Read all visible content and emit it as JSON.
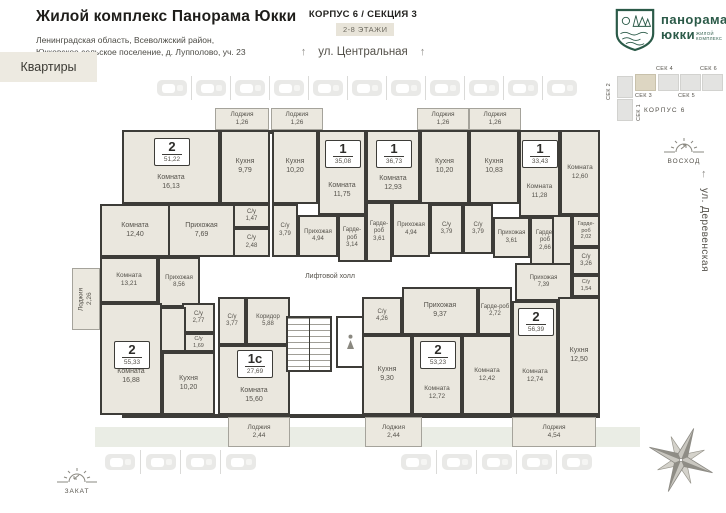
{
  "header": {
    "title": "Жилой комплекс Панорама Юкки",
    "address1": "Ленинградская область, Всеволжский район,",
    "address2": "Юкковское сельское поселение, д. Лупполово, уч. 23",
    "apartments_button": "Квартиры",
    "korpus": "КОРПУС 6 / СЕКЦИЯ 3",
    "floors_badge": "2-8 ЭТАЖИ",
    "street_top": "ул. Центральная",
    "street_right": "ул. Деревенская"
  },
  "logo": {
    "line1": "панорама",
    "line2": "юкки",
    "sub1": "жилой",
    "sub2": "комплекс"
  },
  "minimap": {
    "sec1": "СЕК 1",
    "sec2": "СЕК 2",
    "sec3": "СЕК 3",
    "sec4": "СЕК 4",
    "sec5": "СЕК 5",
    "sec6": "СЕК 6",
    "korpus": "КОРПУС 6",
    "active_section": "СЕК 3"
  },
  "legend": {
    "sunrise": "ВОСХОД",
    "sunset": "ЗАКАТ"
  },
  "colors": {
    "wall": "#3d3c38",
    "room_fill": "#eae7de",
    "accent_beige": "#edeae1",
    "logo_green": "#2b5a48"
  },
  "plan": {
    "lift_hall_label": "Лифтовой холл",
    "apartments": [
      {
        "type": "2",
        "area": "51,22",
        "bx": 171,
        "by": 138
      },
      {
        "type": "1",
        "area": "35,08",
        "bx": 342,
        "by": 140
      },
      {
        "type": "1",
        "area": "36,73",
        "bx": 393,
        "by": 140
      },
      {
        "type": "1",
        "area": "33,43",
        "bx": 539,
        "by": 140
      },
      {
        "type": "2",
        "area": "56,39",
        "bx": 535,
        "by": 308
      },
      {
        "type": "2",
        "area": "53,23",
        "bx": 437,
        "by": 341
      },
      {
        "type": "2",
        "area": "55,33",
        "bx": 131,
        "by": 341
      },
      {
        "type": "1с",
        "area": "27,69",
        "bx": 254,
        "by": 350
      }
    ],
    "rooms": [
      {
        "name": "Комната",
        "area": "16,13",
        "x": 122,
        "y": 130,
        "w": 98,
        "h": 74,
        "pt": 32
      },
      {
        "name": "Кухня",
        "area": "9,79",
        "x": 220,
        "y": 130,
        "w": 50,
        "h": 74
      },
      {
        "name": "С/у",
        "area": "1,47",
        "x": 233,
        "y": 204,
        "w": 37,
        "h": 24,
        "fs": 6
      },
      {
        "name": "С/у",
        "area": "2,48",
        "x": 233,
        "y": 228,
        "w": 37,
        "h": 29,
        "fs": 6
      },
      {
        "name": "Прихожая",
        "area": "7,69",
        "x": 168,
        "y": 204,
        "w": 67,
        "h": 53
      },
      {
        "name": "Комната",
        "area": "12,40",
        "x": 100,
        "y": 204,
        "w": 70,
        "h": 53
      },
      {
        "name": "Кухня",
        "area": "10,20",
        "x": 272,
        "y": 130,
        "w": 46,
        "h": 74
      },
      {
        "name": "Комната",
        "area": "11,75",
        "x": 318,
        "y": 130,
        "w": 48,
        "h": 85,
        "pt": 36
      },
      {
        "name": "С/у",
        "area": "3,79",
        "x": 272,
        "y": 204,
        "w": 26,
        "h": 53,
        "fs": 6
      },
      {
        "name": "Прихожая",
        "area": "4,94",
        "x": 298,
        "y": 215,
        "w": 40,
        "h": 42,
        "fs": 6
      },
      {
        "name": "Гарде-роб",
        "area": "3,14",
        "x": 338,
        "y": 215,
        "w": 28,
        "h": 47,
        "fs": 6
      },
      {
        "name": "Комната",
        "area": "12,93",
        "x": 366,
        "y": 130,
        "w": 54,
        "h": 72,
        "pt": 36
      },
      {
        "name": "Кухня",
        "area": "10,20",
        "x": 420,
        "y": 130,
        "w": 49,
        "h": 74
      },
      {
        "name": "Гарде-роб",
        "area": "3,61",
        "x": 366,
        "y": 202,
        "w": 26,
        "h": 60,
        "fs": 6
      },
      {
        "name": "Прихожая",
        "area": "4,94",
        "x": 392,
        "y": 202,
        "w": 38,
        "h": 55,
        "fs": 6
      },
      {
        "name": "С/у",
        "area": "3,79",
        "x": 430,
        "y": 204,
        "w": 33,
        "h": 50,
        "fs": 6
      },
      {
        "name": "Кухня",
        "area": "10,83",
        "x": 469,
        "y": 130,
        "w": 50,
        "h": 74
      },
      {
        "name": "Комната",
        "area": "11,28",
        "x": 519,
        "y": 130,
        "w": 41,
        "h": 87,
        "pt": 36,
        "fs": 6.5
      },
      {
        "name": "С/у",
        "area": "3,79",
        "x": 463,
        "y": 204,
        "w": 30,
        "h": 50,
        "fs": 6
      },
      {
        "name": "Прихожая",
        "area": "3,61",
        "x": 493,
        "y": 217,
        "w": 37,
        "h": 41,
        "fs": 6
      },
      {
        "name": "Гарде-роб",
        "area": "2,66",
        "x": 530,
        "y": 217,
        "w": 30,
        "h": 48,
        "fs": 6
      },
      {
        "name": "Комната",
        "area": "12,60",
        "x": 560,
        "y": 130,
        "w": 40,
        "h": 85,
        "fs": 6.5
      },
      {
        "name": "Гарде-роб",
        "area": "2,02",
        "x": 572,
        "y": 215,
        "w": 28,
        "h": 32,
        "fs": 5.5
      },
      {
        "name": "С/у",
        "area": "3,26",
        "x": 572,
        "y": 247,
        "w": 28,
        "h": 28,
        "fs": 6
      },
      {
        "name": "С/у",
        "area": "1,54",
        "x": 572,
        "y": 275,
        "w": 28,
        "h": 22,
        "fs": 5.5
      },
      {
        "name": "",
        "area": "",
        "x": 552,
        "y": 215,
        "w": 20,
        "h": 50
      },
      {
        "name": "Прихожая",
        "area": "7,39",
        "x": 515,
        "y": 263,
        "w": 57,
        "h": 38,
        "fs": 6
      },
      {
        "name": "Комната",
        "area": "12,74",
        "x": 512,
        "y": 301,
        "w": 46,
        "h": 114,
        "pt": 36,
        "fs": 6.5
      },
      {
        "name": "Кухня",
        "area": "12,50",
        "x": 558,
        "y": 297,
        "w": 42,
        "h": 118
      },
      {
        "name": "С/у",
        "area": "4,26",
        "x": 362,
        "y": 297,
        "w": 40,
        "h": 38,
        "fs": 6
      },
      {
        "name": "Прихожая",
        "area": "9,37",
        "x": 402,
        "y": 287,
        "w": 76,
        "h": 48
      },
      {
        "name": "Гарде-роб",
        "area": "2,72",
        "x": 478,
        "y": 287,
        "w": 34,
        "h": 48,
        "fs": 6
      },
      {
        "name": "Кухня",
        "area": "9,30",
        "x": 362,
        "y": 335,
        "w": 50,
        "h": 80
      },
      {
        "name": "Комната",
        "area": "12,72",
        "x": 412,
        "y": 335,
        "w": 50,
        "h": 80,
        "pt": 36,
        "fs": 6.5
      },
      {
        "name": "Комната",
        "area": "12,42",
        "x": 462,
        "y": 335,
        "w": 50,
        "h": 80,
        "fs": 6.5
      },
      {
        "name": "Комната",
        "area": "13,21",
        "x": 100,
        "y": 257,
        "w": 58,
        "h": 46,
        "fs": 6.5
      },
      {
        "name": "Прихожая",
        "area": "8,56",
        "x": 158,
        "y": 257,
        "w": 42,
        "h": 50,
        "fs": 6
      },
      {
        "name": "С/у",
        "area": "2,77",
        "x": 182,
        "y": 303,
        "w": 33,
        "h": 30,
        "fs": 6
      },
      {
        "name": "С/у",
        "area": "1,69",
        "x": 182,
        "y": 333,
        "w": 33,
        "h": 19,
        "fs": 5.5
      },
      {
        "name": "",
        "area": "",
        "x": 158,
        "y": 307,
        "w": 28,
        "h": 45
      },
      {
        "name": "Комната",
        "area": "16,88",
        "x": 100,
        "y": 303,
        "w": 62,
        "h": 112,
        "pt": 36
      },
      {
        "name": "Кухня",
        "area": "10,20",
        "x": 162,
        "y": 352,
        "w": 53,
        "h": 63
      },
      {
        "name": "С/у",
        "area": "3,77",
        "x": 218,
        "y": 297,
        "w": 28,
        "h": 48,
        "fs": 6
      },
      {
        "name": "Коридор",
        "area": "5,88",
        "x": 246,
        "y": 297,
        "w": 44,
        "h": 48,
        "fs": 6
      },
      {
        "name": "Комната",
        "area": "15,60",
        "x": 218,
        "y": 345,
        "w": 72,
        "h": 70,
        "pt": 32
      }
    ],
    "loggias": [
      {
        "name": "Лоджия",
        "area": "1,26",
        "x": 215,
        "y": 108,
        "w": 54,
        "h": 22
      },
      {
        "name": "Лоджия",
        "area": "1,26",
        "x": 271,
        "y": 108,
        "w": 52,
        "h": 22
      },
      {
        "name": "Лоджия",
        "area": "1,26",
        "x": 417,
        "y": 108,
        "w": 52,
        "h": 22
      },
      {
        "name": "Лоджия",
        "area": "1,26",
        "x": 469,
        "y": 108,
        "w": 52,
        "h": 22
      },
      {
        "name": "Лоджия",
        "area": "2,26",
        "x": 72,
        "y": 268,
        "w": 28,
        "h": 62,
        "vert": true
      },
      {
        "name": "Лоджия",
        "area": "2,44",
        "x": 228,
        "y": 417,
        "w": 62,
        "h": 30
      },
      {
        "name": "Лоджия",
        "area": "2,44",
        "x": 365,
        "y": 417,
        "w": 57,
        "h": 30
      },
      {
        "name": "Лоджия",
        "area": "4,54",
        "x": 512,
        "y": 417,
        "w": 84,
        "h": 30
      }
    ]
  },
  "parking": {
    "rows": [
      {
        "x": 152,
        "y": 76,
        "count": 11,
        "step": 39
      },
      {
        "x": 100,
        "y": 450,
        "count": 4,
        "step": 40
      },
      {
        "x": 396,
        "y": 450,
        "count": 5,
        "step": 40
      }
    ]
  }
}
